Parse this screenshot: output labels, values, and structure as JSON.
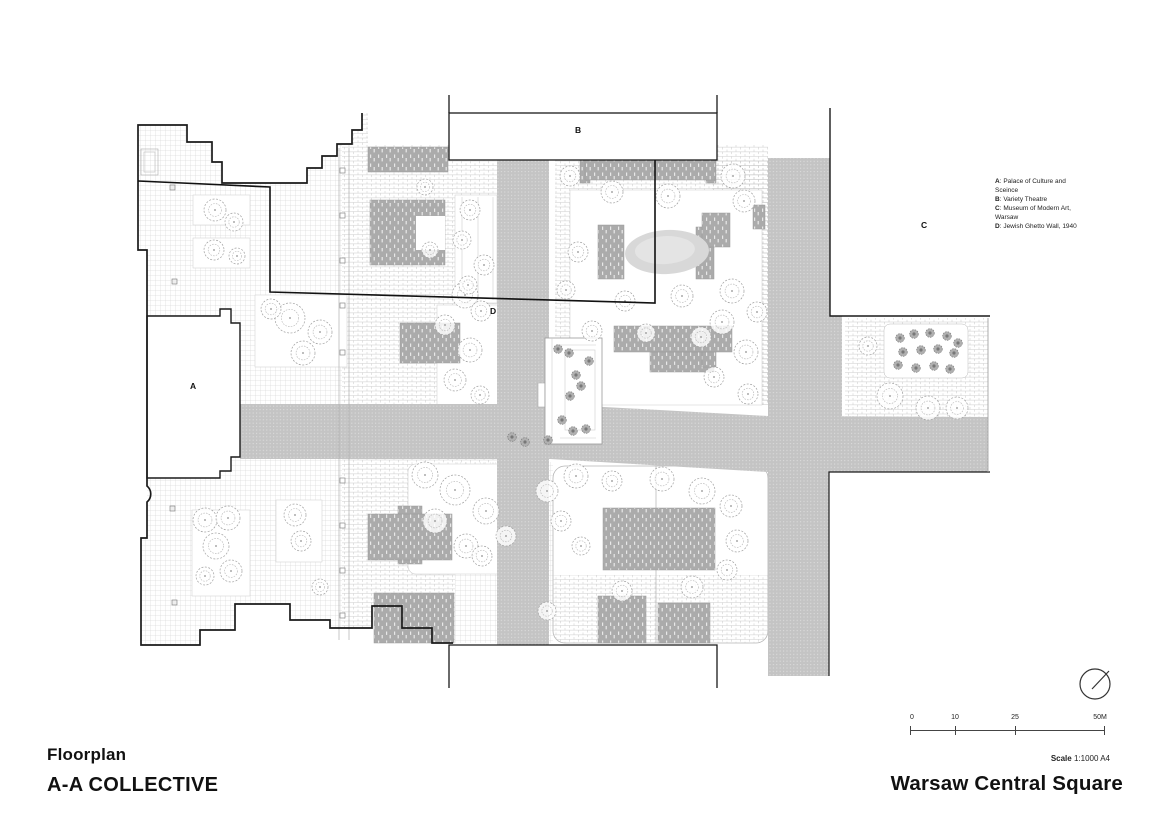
{
  "document": {
    "type_label": "Floorplan",
    "author": "A-A COLLECTIVE",
    "project": "Warsaw Central Square"
  },
  "legend": {
    "items": [
      {
        "key": "A",
        "desc": ": Palace of Culture and Sceince"
      },
      {
        "key": "B",
        "desc": ": Variety Theatre"
      },
      {
        "key": "C",
        "desc": ": Museum of Modern Art, Warsaw"
      },
      {
        "key": "D",
        "desc": ": Jewish Ghetto Wall, 1940"
      }
    ]
  },
  "plan": {
    "markers": {
      "a": "A",
      "b": "B",
      "c": "C",
      "d": "D"
    }
  },
  "scale_bar": {
    "ticks": [
      "0",
      "10",
      "25",
      "50M"
    ],
    "label_bold": "Scale",
    "label_value": "1:1000 A4"
  },
  "colors": {
    "ink": "#1a1a1a",
    "road_gray": "#c4c4c4",
    "building_gray": "#ababab",
    "paving_line": "#cdcdcd",
    "tree_line": "#a0a0a0"
  }
}
